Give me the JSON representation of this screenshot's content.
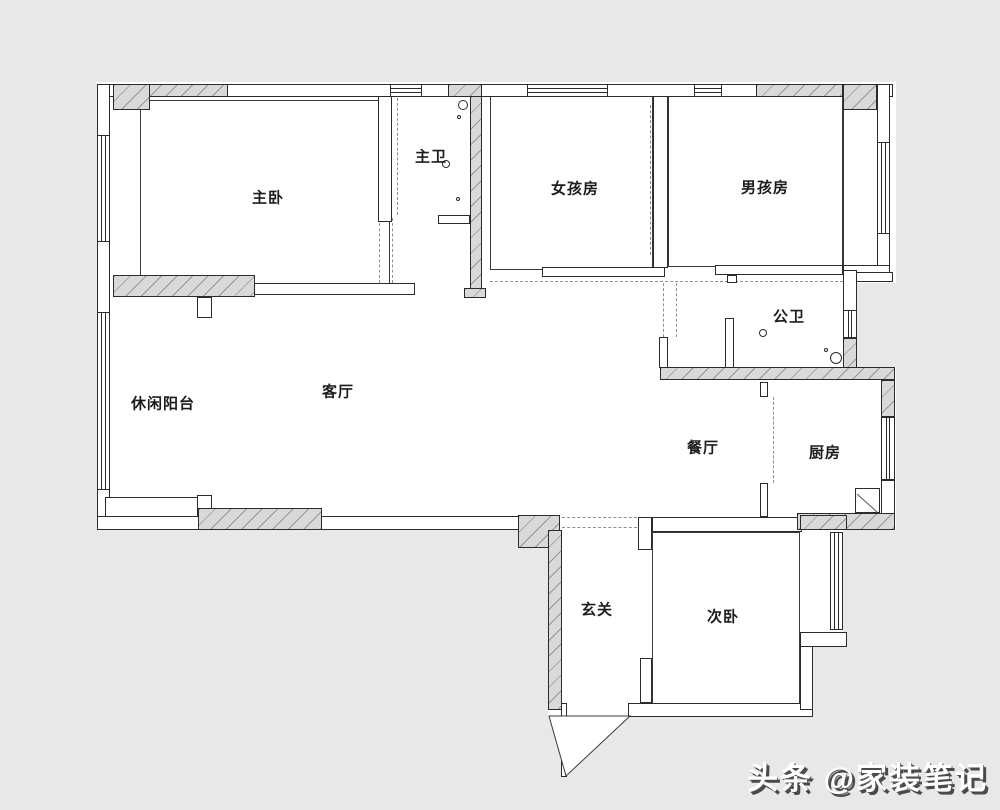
{
  "page": {
    "background_color": "#e8e8e8",
    "paper_color": "#ffffff",
    "line_color": "#2b2b2b",
    "hatch_fill_color": "#d9d9d9"
  },
  "floorplan": {
    "rooms": [
      {
        "id": "master-bedroom",
        "label": "主卧",
        "x": 268,
        "y": 197
      },
      {
        "id": "master-bath",
        "label": "主卫",
        "x": 431,
        "y": 156
      },
      {
        "id": "girls-room",
        "label": "女孩房",
        "x": 575,
        "y": 188
      },
      {
        "id": "boys-room",
        "label": "男孩房",
        "x": 765,
        "y": 187
      },
      {
        "id": "public-bath",
        "label": "公卫",
        "x": 789,
        "y": 316
      },
      {
        "id": "leisure-balcony",
        "label": "休闲阳台",
        "x": 163,
        "y": 403
      },
      {
        "id": "living-room",
        "label": "客厅",
        "x": 338,
        "y": 391
      },
      {
        "id": "dining-room",
        "label": "餐厅",
        "x": 703,
        "y": 447
      },
      {
        "id": "kitchen",
        "label": "厨房",
        "x": 825,
        "y": 452
      },
      {
        "id": "entryway",
        "label": "玄关",
        "x": 597,
        "y": 609
      },
      {
        "id": "second-bedroom",
        "label": "次卧",
        "x": 723,
        "y": 616
      }
    ],
    "bathroom_fixtures": [
      {
        "name": "fixture-circle",
        "x": 463,
        "y": 105,
        "r": 5
      },
      {
        "name": "fixture-circle",
        "x": 459,
        "y": 117,
        "r": 2
      },
      {
        "name": "fixture-circle",
        "x": 446,
        "y": 164,
        "r": 4
      },
      {
        "name": "fixture-circle",
        "x": 458,
        "y": 199,
        "r": 2
      },
      {
        "name": "fixture-circle",
        "x": 763,
        "y": 333,
        "r": 4
      },
      {
        "name": "fixture-circle",
        "x": 826,
        "y": 350,
        "r": 2
      },
      {
        "name": "fixture-circle",
        "x": 836,
        "y": 358,
        "r": 6
      }
    ]
  },
  "watermark": {
    "text": "头条 @家装笔记",
    "color": "#ffffff",
    "shadow_color": "#4a4a4a"
  }
}
